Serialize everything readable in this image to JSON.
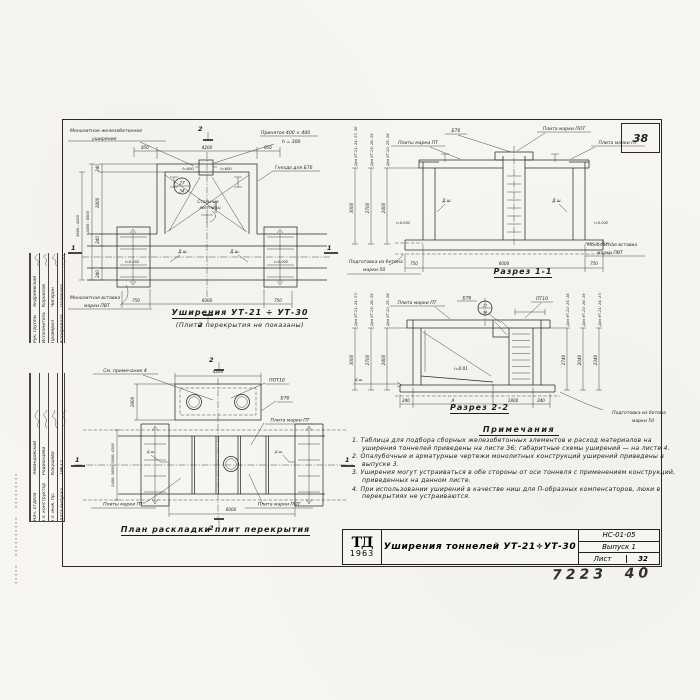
{
  "sheet": {
    "corner_number": "38",
    "handwritten": "7223  40"
  },
  "stamp": {
    "top_rows": [
      {
        "role": "Рук. группы",
        "name": "Андреевский"
      },
      {
        "role": "Исполнитель",
        "name": "Корнилов"
      },
      {
        "role": "Проверил",
        "name": "Чигарин"
      },
      {
        "role": "Копировала",
        "name": "Полякова"
      }
    ],
    "bottom_rows": [
      {
        "role": "Нач. отдела",
        "name": "Левандовский"
      },
      {
        "role": "Гл. конструктор",
        "name": "Родионцева"
      },
      {
        "role": "Гл. инж. пр.",
        "name": "Кокушева"
      },
      {
        "role": "Дата выпуска",
        "name": "1963 г."
      }
    ]
  },
  "plan_widening": {
    "labels": {
      "monolithic": "Монолитное  железобетонное",
      "monolithic2": "уширение",
      "accepted": "Принятое  400 × 400",
      "accepted2": "h = 300",
      "socket": "Гнездо для БТ6",
      "insert": "Монолитная  вставка",
      "insert2": "марки  ПВТ",
      "ladders": "Стальные",
      "ladders2": "лестницы",
      "node_top": "27",
      "node_bottom": "34",
      "dsh": "Д.ш.",
      "slope": "i=0.002",
      "l800": "ℓ=800",
      "l600": "ℓ=600",
      "l400": "ℓ=400"
    },
    "dims": {
      "top": [
        "850",
        "4200",
        "850"
      ],
      "bottom": [
        "750",
        "6000",
        "750"
      ],
      "left": [
        "240",
        "1800",
        "240"
      ],
      "left_bottom": "240",
      "left_rot1": "2400 ; 6000",
      "left_rot2": "3600 ; 4200"
    },
    "section_marks": {
      "cut1": "1",
      "cut2": "2"
    },
    "title": "Уширения  УТ-21 ÷ УТ-30",
    "subtitle": "(Плиты перекрытия не показаны)"
  },
  "section1": {
    "title": "Разрез  1-1",
    "labels": {
      "bt6": "БТ6",
      "plate_pot": "Плита марки ПОТ",
      "plates_pt": "Плиты марки ПТ",
      "plate_pt": "Плита марки ПТ",
      "prep": "Подготовка из бетона",
      "prep2": "марки 50",
      "insert": "Монолитная вставка",
      "insert2": "марки ПВТ",
      "dsh": "Д.ш.",
      "slope": "i=0.002"
    },
    "left_chains": [
      {
        "label": "Для УТ-21; 24; 27; 30",
        "value": "3000"
      },
      {
        "label": "Для УТ-23; 26; 29",
        "value": "2700"
      },
      {
        "label": "Для УТ-22; 25; 28",
        "value": "2400"
      }
    ],
    "dims_bottom": [
      "750",
      "6000",
      "750"
    ]
  },
  "section2": {
    "title": "Разрез  2-2",
    "labels": {
      "plate_pt": "Плита марки ПТ",
      "bt6": "БТ6",
      "pt10": "ПТ10",
      "slope": "i=0.01",
      "node_top": "27",
      "node_bottom": "34",
      "prep": "Подготовка из бетона",
      "prep2": "марки 50",
      "dsh": "Д.ш."
    },
    "left_chains": [
      {
        "label": "Для УТ-21; 24; 27; 30",
        "value": "3000"
      },
      {
        "label": "Для УТ-23; 26; 29",
        "value": "2700"
      },
      {
        "label": "Для УТ-22; 25; 28",
        "value": "2400"
      }
    ],
    "right_chains": [
      {
        "label": "Для УТ-22; 25; 28",
        "value": "1740"
      },
      {
        "label": "Для УТ-23; 26; 29",
        "value": "2040"
      },
      {
        "label": "Для УТ-21; 24; 27; 30",
        "value": "2340"
      }
    ],
    "dims_bottom": [
      "240",
      "А",
      "1800",
      "240"
    ]
  },
  "plan_slabs": {
    "title": "План  раскладки  плит  перекрытия",
    "labels": {
      "see_note": "См. примечание 4",
      "pot10": "ПОТ10",
      "bt6": "БТ6",
      "plate_pt": "Плита марки ПТ",
      "plates_pt": "Плиты марки ПТ",
      "plate_pot": "Плита марки ПОТ",
      "dsh": "Д.ш."
    },
    "dims": {
      "top": "4200",
      "left": "1800",
      "left_rot": "2400; 3000; 3600; 4200",
      "bottom": "6000"
    },
    "section_marks": {
      "cut1": "1",
      "cut2": "2"
    }
  },
  "notes": {
    "title": "Примечания",
    "items": [
      "1. Таблица для подбора сборных железобетонных элементов и расход материалов на уширения тоннелей приведены на листе 36; габаритные схемы уширений — на листе 4.",
      "2. Опалубочные и арматурные чертежи монолитных конструкций уширений приведены в выпуске 3.",
      "3. Уширения могут устраиваться в обе стороны от оси тоннеля с применением конструкций, приведенных на данном листе.",
      "4. При использовании уширений в качестве ниш для П-образных компенсаторов, люки в перекрытиях не устраиваются."
    ]
  },
  "titleblock": {
    "logo_top": "ТД",
    "logo_bottom": "1963",
    "title": "Уширения тоннелей УТ-21÷УТ-30",
    "code": "НС-01-05",
    "issue": "Выпуск 1",
    "sheet_label": "Лист",
    "sheet_number": "32"
  }
}
